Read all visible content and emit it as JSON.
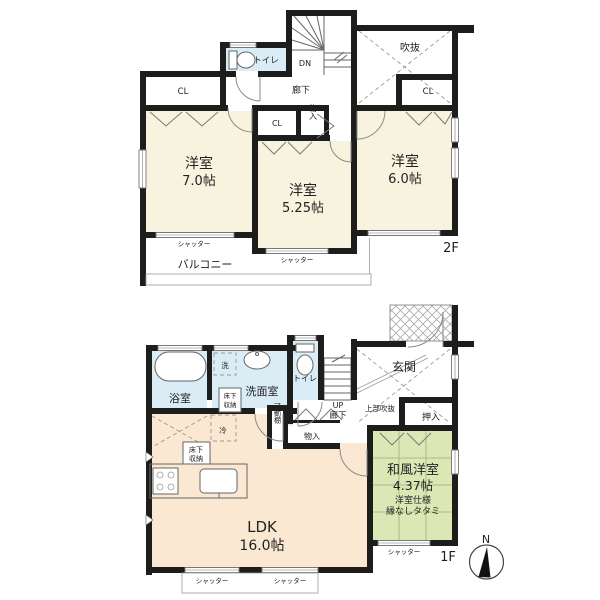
{
  "plan": {
    "common": {
      "cl": "CL",
      "shutter": "シャッター",
      "monoire": "物入",
      "rouka": "廊下",
      "toilet": "トイレ",
      "underfloor_top": "床下",
      "underfloor_bottom": "収納"
    },
    "f2": {
      "floor_label": "2F",
      "dn": "DN",
      "fukinuke": "吹抜",
      "balcony": "バルコニー",
      "room_west_name": "洋室",
      "room_west_size": "7.0帖",
      "room_center_name": "洋室",
      "room_center_size": "5.25帖",
      "room_east_name": "洋室",
      "room_east_size": "6.0帖"
    },
    "f1": {
      "floor_label": "1F",
      "bath": "浴室",
      "laundry": "洗",
      "washroom": "洗面室",
      "up": "UP",
      "entrance": "玄関",
      "upper_void": "上部吹抜",
      "oshiire": "押入",
      "movable_shelf": "可動棚",
      "fridge": "冷",
      "ldk_name": "LDK",
      "ldk_size": "16.0帖",
      "jp_room_name": "和風洋室",
      "jp_room_size": "4.37帖",
      "jp_room_note1": "洋室仕様",
      "jp_room_note2": "縁なしタタミ"
    },
    "compass_north": "N",
    "colors": {
      "wall": "#1d1d1b",
      "western_room": "#f7f3de",
      "ldk": "#fae8d2",
      "tatami_room": "#dbe7b5",
      "wet_area": "#daecf5",
      "tatami_line": "#a9bd7f"
    }
  }
}
